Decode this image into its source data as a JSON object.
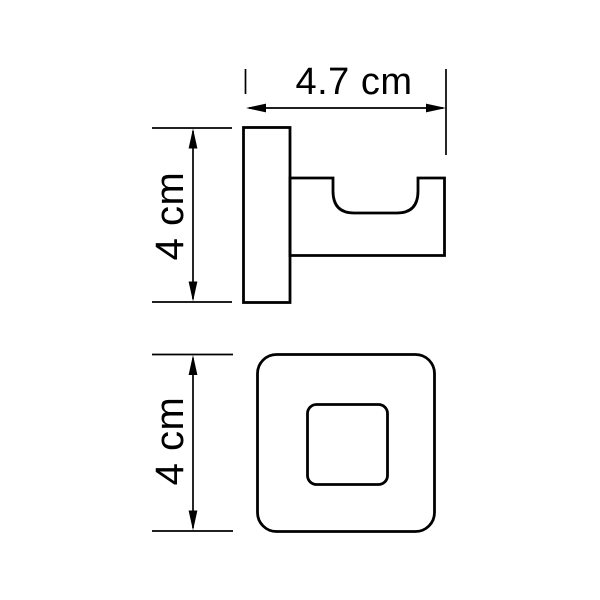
{
  "colors": {
    "line": "#000000",
    "background": "#ffffff"
  },
  "dimensions": {
    "width": {
      "label": "4.7 cm",
      "value_cm": 4.7
    },
    "height_side": {
      "label": "4 cm",
      "value_cm": 4
    },
    "height_front": {
      "label": "4 cm",
      "value_cm": 4
    }
  }
}
